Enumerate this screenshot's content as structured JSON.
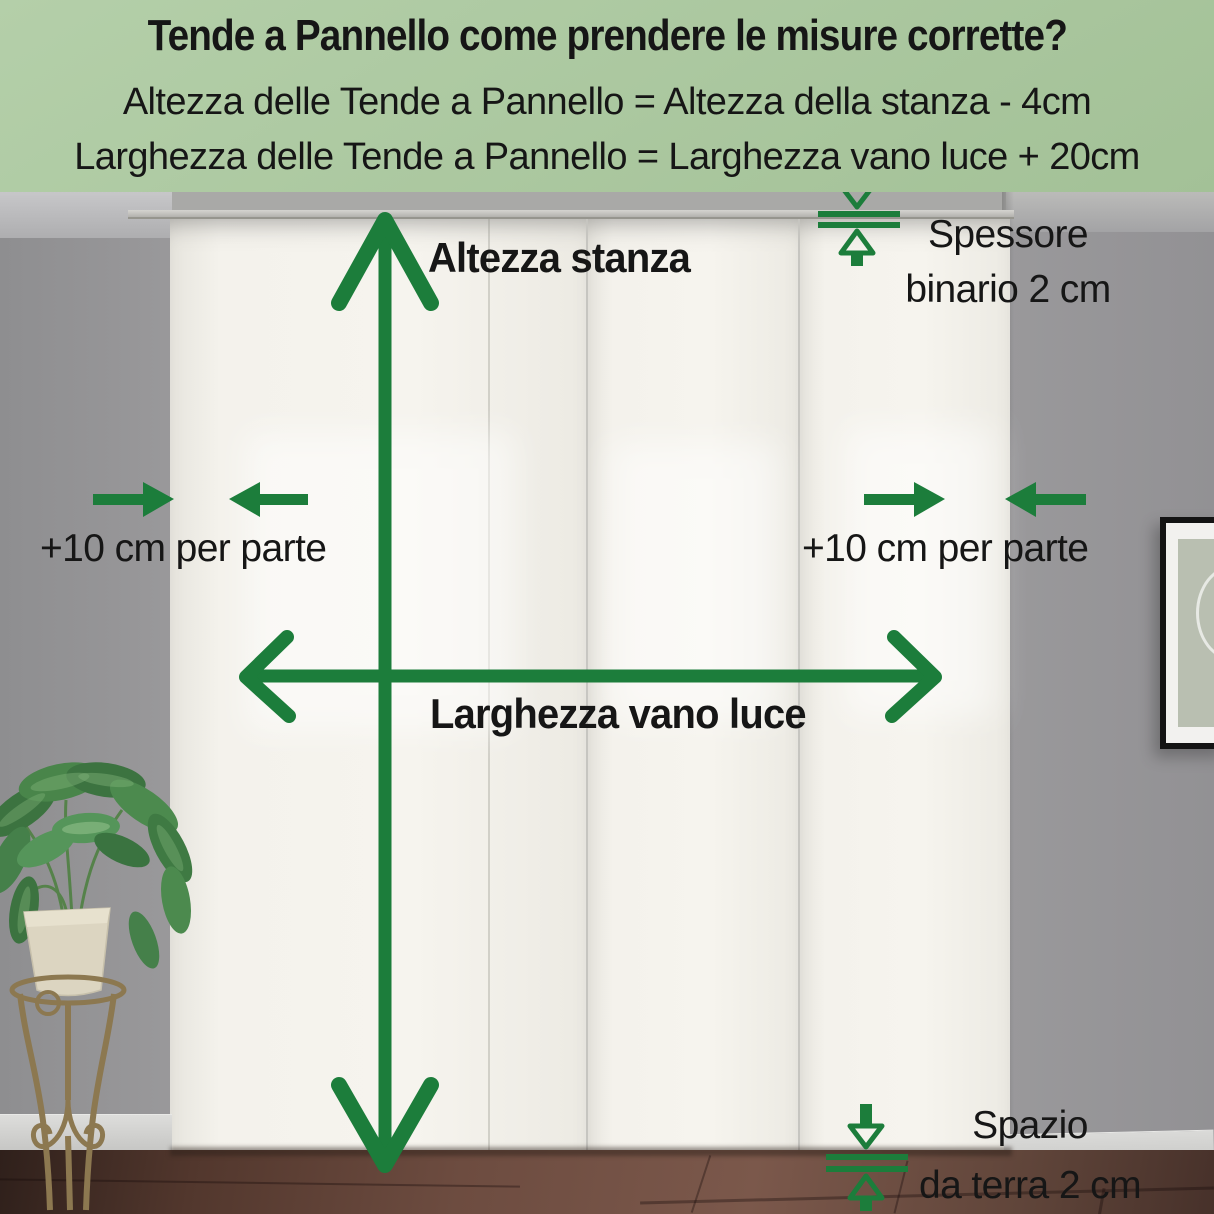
{
  "header": {
    "title": "Tende a Pannello come prendere le misure corrette?",
    "formula_height": "Altezza delle Tende a Pannello = Altezza della stanza - 4cm",
    "formula_width": "Larghezza delle Tende a Pannello = Larghezza vano luce + 20cm"
  },
  "labels": {
    "room_height": "Altezza stanza",
    "opening_width": "Larghezza vano luce",
    "rail_thickness_line1": "Spessore",
    "rail_thickness_line2": "binario 2 cm",
    "side_margin_left": "+10 cm per parte",
    "side_margin_right": "+10 cm per parte",
    "floor_gap_line1": "Spazio",
    "floor_gap_line2": "da terra 2 cm"
  },
  "colors": {
    "accent_green": "#1c7d3b",
    "header_bg": "#b4cfa9",
    "header_bg_dark": "#a3c197",
    "label_text": "#161616",
    "wall_gray": "#9a999b",
    "curtain_white": "#f4f2ec",
    "floor_brown": "#6b4b3f"
  }
}
